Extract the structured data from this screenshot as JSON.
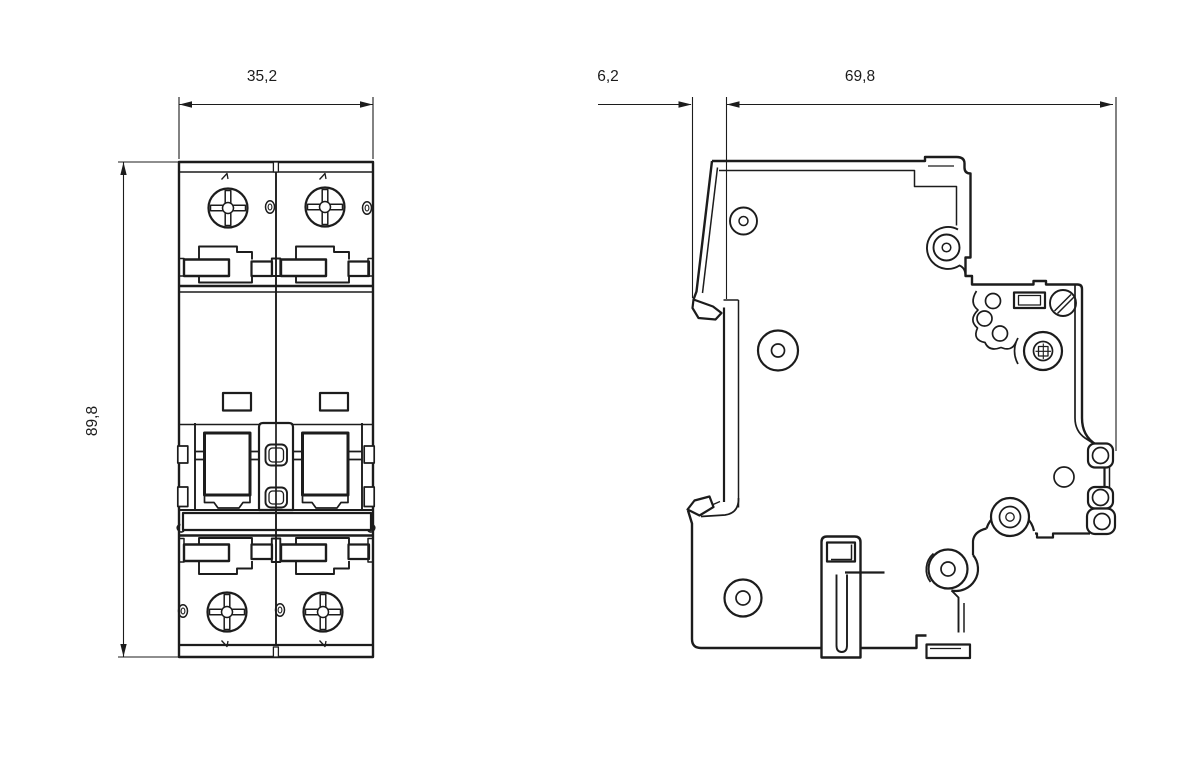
{
  "page": {
    "background_color": "#ffffff",
    "line_color": "#1c1c1c"
  },
  "dimensions": {
    "front_width": {
      "label": "35,2"
    },
    "front_height": {
      "label": "89,8"
    },
    "side_offset": {
      "label": "6,2"
    },
    "side_depth": {
      "label": "69,8"
    }
  }
}
